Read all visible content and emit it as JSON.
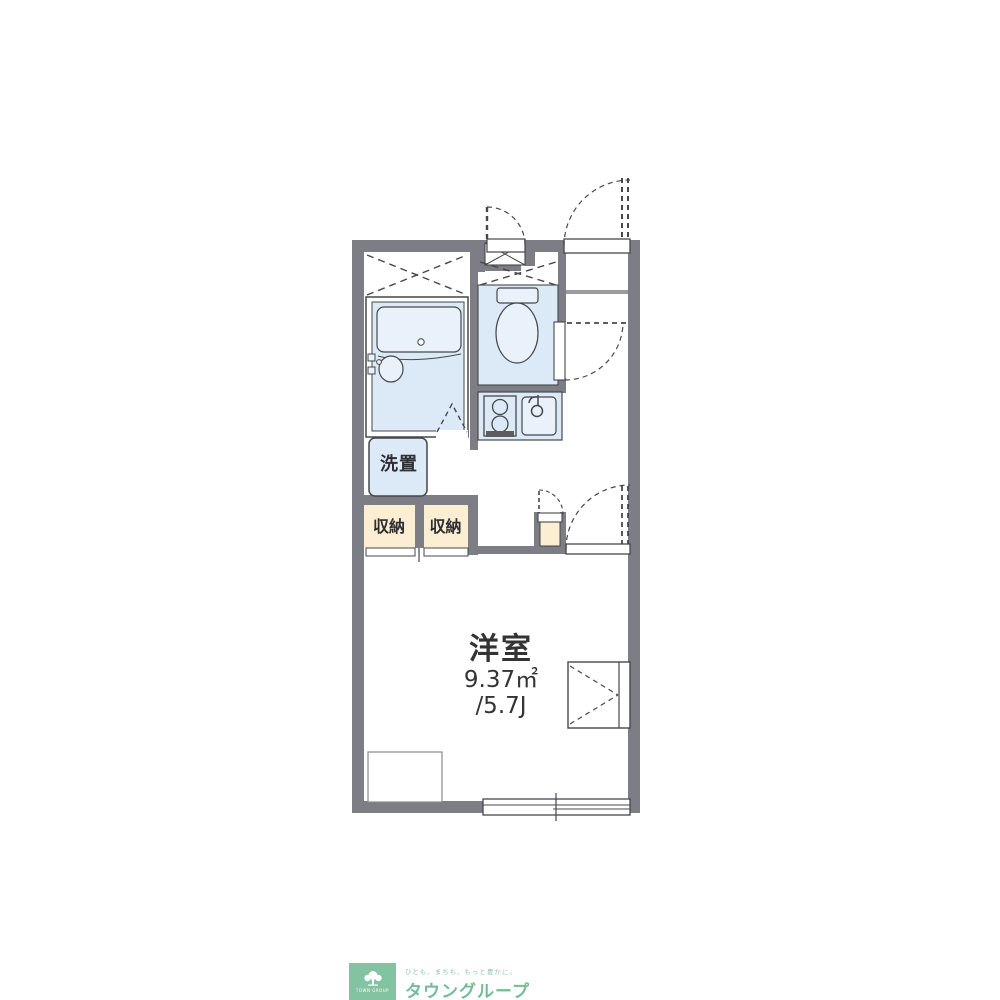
{
  "floorplan": {
    "rooms": {
      "main_room": {
        "label": "洋室",
        "area_m2": "9.37㎡",
        "area_jo": "/5.7J"
      },
      "washer_space": {
        "label": "洗置"
      },
      "closet_left": {
        "label": "収納"
      },
      "closet_right": {
        "label": "収納"
      }
    },
    "fixtures": [
      "bathtub",
      "wash-basin",
      "toilet",
      "stove-2-burner",
      "kitchen-sink",
      "sliding-window",
      "entry-door",
      "folding-bath-door",
      "shoe-storage",
      "wall-cabinet",
      "desk"
    ],
    "colors": {
      "wall": "#7d7d85",
      "line": "#45474b",
      "fixture_blue": "#dce9f7",
      "fixture_blue_light": "#e9f2fb",
      "closet_cream": "#fbeed3"
    }
  },
  "footer_logo": {
    "icon_label": "TOWN GROUP",
    "tagline": "ひとも、まちも、もっと豊かに。",
    "brand": "タウングループ",
    "green": "#82c3a1"
  }
}
